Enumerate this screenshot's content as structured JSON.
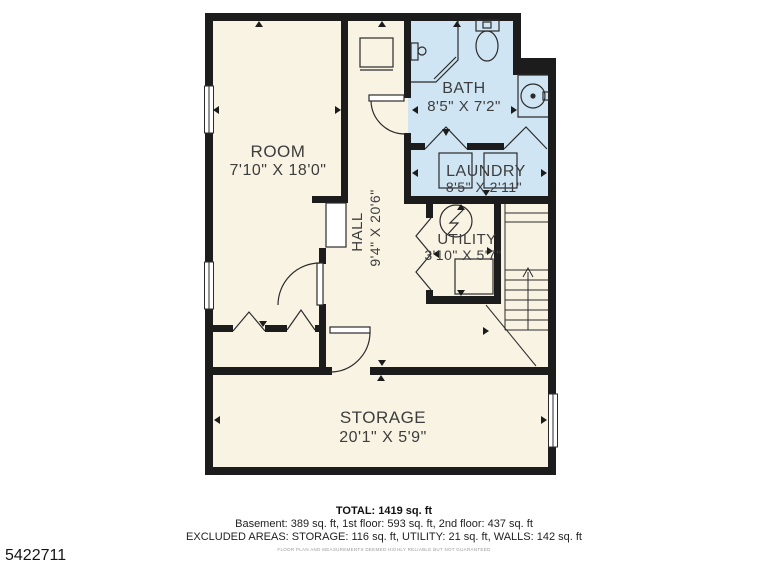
{
  "image_id": "5422711",
  "colors": {
    "floor": "#f9f3e3",
    "wet_room": "#cfe5f4",
    "wall": "#1c1c1c",
    "thin_line": "#2b2b2b"
  },
  "rooms": {
    "room": {
      "name": "ROOM",
      "dims": "7'10\" X 18'0\""
    },
    "hall": {
      "name": "HALL",
      "dims": "9'4\" X 20'6\""
    },
    "bath": {
      "name": "BATH",
      "dims": "8'5\" X 7'2\""
    },
    "laundry": {
      "name": "LAUNDRY",
      "dims": "8'5\" X 2'11\""
    },
    "utility": {
      "name": "UTILITY",
      "dims": "3'10\" X 5'7\""
    },
    "storage": {
      "name": "STORAGE",
      "dims": "20'1\" X 5'9\""
    }
  },
  "summary": {
    "total": "TOTAL: 1419 sq. ft",
    "floors": "Basement: 389 sq. ft, 1st floor: 593 sq. ft, 2nd floor: 437 sq. ft",
    "excluded": "EXCLUDED AREAS: STORAGE: 116 sq. ft, UTILITY: 21 sq. ft, WALLS: 142 sq. ft",
    "disclaimer": "FLOOR PLAN AND MEASUREMENTS DEEMED HIGHLY RELIABLE BUT NOT GUARANTEED"
  }
}
